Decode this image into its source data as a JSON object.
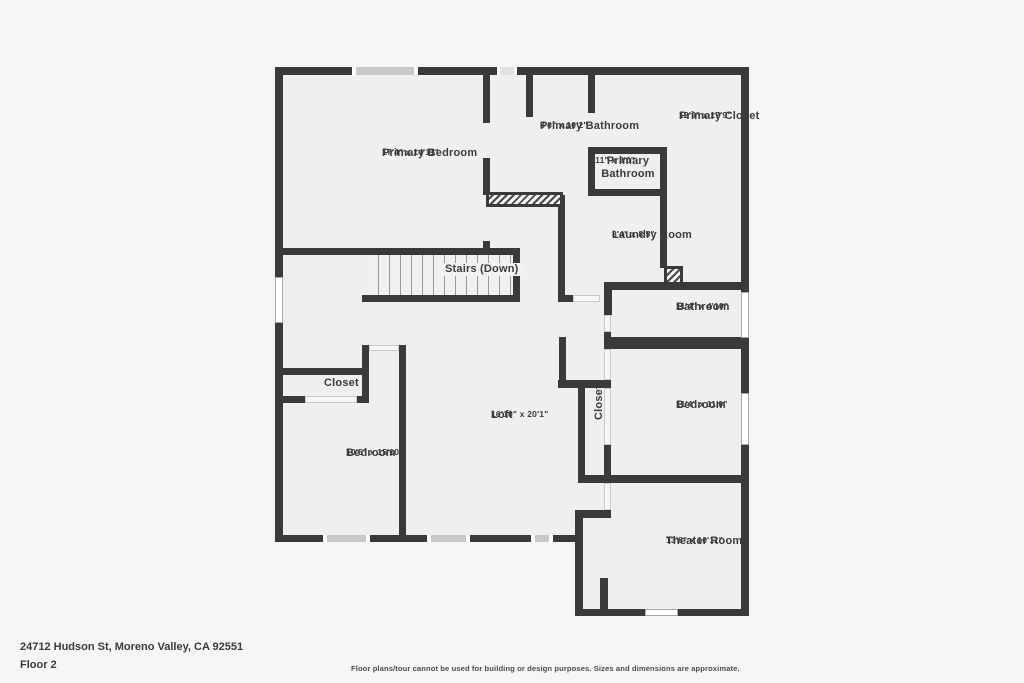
{
  "address": "24712 Hudson St, Moreno Valley, CA 92551",
  "floor_label": "Floor 2",
  "disclaimer": "Floor plans/tour cannot be used for building or design purposes. Sizes and dimensions are approximate.",
  "colors": {
    "wall": "#3b3a39",
    "floor": "#f1efed",
    "background": "#f7f6f5",
    "text": "#3c3c3c"
  },
  "rooms": [
    {
      "name": "Primary Bedroom",
      "dims": "17'4\" x 14'11\""
    },
    {
      "name": "Primary Bathroom",
      "dims": "8'6\" x 10'2\""
    },
    {
      "name": "Primary Closet",
      "dims": "12'9\" x 17'9\""
    },
    {
      "name": "Primary Bathroom",
      "dims": "5'11\" x 3'0\""
    },
    {
      "name": "Laundry Room",
      "dims": "8'4\" x 8'5\""
    },
    {
      "name": "Stairs (Down)",
      "dims": ""
    },
    {
      "name": "Bathroom",
      "dims": "11'4\" x 4'10\""
    },
    {
      "name": "Bedroom",
      "dims": "11'4\" x 11'0\""
    },
    {
      "name": "Closet",
      "dims": ""
    },
    {
      "name": "Loft",
      "dims": "16'10\" x 20'1\""
    },
    {
      "name": "Closet",
      "dims": ""
    },
    {
      "name": "Bedroom",
      "dims": "10'5\" x 15'10\""
    },
    {
      "name": "Theater Room",
      "dims": "13'8\" x 10'11\""
    }
  ]
}
